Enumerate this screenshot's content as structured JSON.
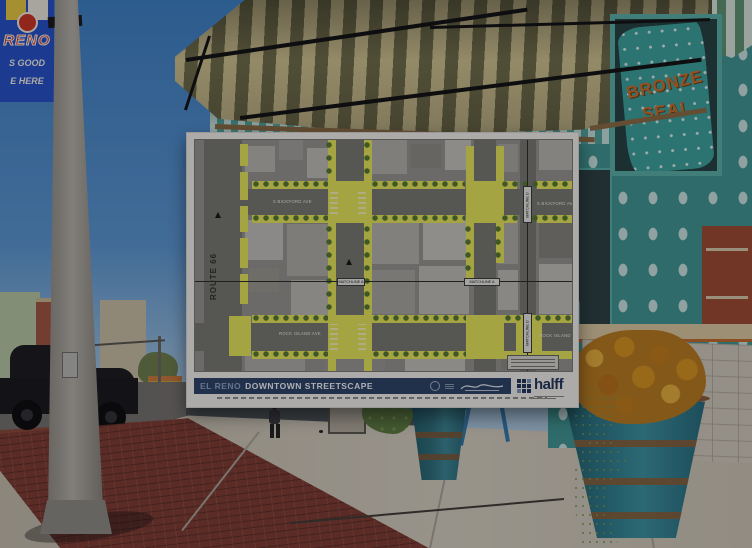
{
  "colors": {
    "sky": "#3c7fc4",
    "awning-cream": "#cfc28e",
    "awning-olive": "#6f6c47",
    "fascia-teal": "#4fa39c",
    "fascia-light": "#c4e2dc",
    "wall-teal": "#3f9691",
    "brick-red": "#7e3b30",
    "navy": "#2c4266",
    "halff-navy": "#23365a",
    "highlight": "#e8e75a",
    "tree": "#55792f",
    "pot-teal": "#2e7d8c",
    "banner-blue": "#2450c8",
    "sign-orange": "#c8722e",
    "poster-bg": "#f2f1ec"
  },
  "scene": {
    "lamp_banner": {
      "title": "RENO",
      "line2": "S GOOD",
      "line3": "E HERE"
    },
    "window_sign": {
      "line1": "BRONZE",
      "line2": "SEAL"
    }
  },
  "poster": {
    "titlebar": {
      "city": "EL RENO",
      "title": "DOWNTOWN STREETSCAPE"
    },
    "firm": {
      "name": "halff"
    },
    "map": {
      "route66": "ROUTE 66",
      "bickford": "S BICKFORD AVE",
      "rock_island": "ROCK ISLAND AVE",
      "matchline_a": "MATCHLINE A",
      "matchline_d": "MATCHLINE D"
    }
  }
}
